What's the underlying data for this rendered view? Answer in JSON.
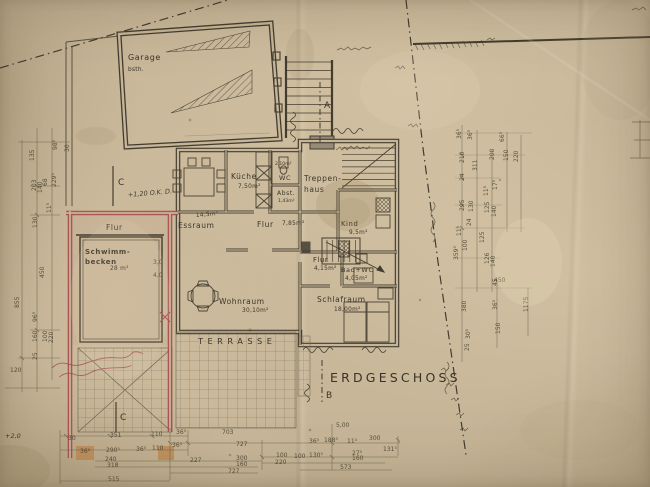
{
  "meta": {
    "type": "architectural floor plan (aged hand-drawn blueprint)",
    "floor": "ERDGESCHOSS"
  },
  "colors": {
    "paper": "#c7b698",
    "ink": "#3e382d",
    "red_pencil": "#a84a52",
    "orange_pencil": "#bf8a52",
    "dim_line": "#5b5442"
  },
  "labels": {
    "garage": {
      "name": "Garage",
      "sub": "bsth."
    },
    "kueche": {
      "name": "Küche",
      "area": "7,50m²"
    },
    "wc": {
      "name": "WC",
      "area": "2,10m²"
    },
    "abstellraum": {
      "name": "Abst.",
      "area": "1,43m²"
    },
    "treppenhaus": {
      "line1": "Treppen-",
      "line2": "haus"
    },
    "essraum": {
      "name": "Essraum",
      "area": "14,5m²"
    },
    "flur_eg": {
      "name": "Flur",
      "area": "7,85m²"
    },
    "kind": {
      "name": "Kind",
      "area": "9,5m²"
    },
    "flur_klein": {
      "name": "Flur",
      "area": "4,15m²"
    },
    "bad": {
      "name": "Bad+WC",
      "area": "4,05m²"
    },
    "wohnraum": {
      "name": "Wohnraum",
      "area": "30,10m²"
    },
    "schlafraum": {
      "name": "Schlafraum",
      "area": "18,00m²"
    },
    "flur_pool": {
      "name": "Flur"
    },
    "schwimmbecken": {
      "line1": "Schwimm-",
      "line2": "becken",
      "area": "28 m²"
    },
    "terrasse": {
      "name": "TERRASSE"
    },
    "erdgeschoss": "ERDGESCHOSS",
    "red_note": "+1,20 O.K. D.",
    "hand_mark": "+2,0"
  },
  "markers": {
    "a": "A",
    "b": "B",
    "c_left": "C",
    "c_bottom": "C"
  },
  "dim_texts": [
    {
      "t": "30",
      "x": 68,
      "y": 440
    },
    {
      "t": "351",
      "x": 110,
      "y": 437
    },
    {
      "t": "110",
      "x": 151,
      "y": 436
    },
    {
      "t": "36⁵",
      "x": 176,
      "y": 434
    },
    {
      "t": "703",
      "x": 222,
      "y": 434
    },
    {
      "t": "36⁵",
      "x": 80,
      "y": 453
    },
    {
      "t": "290⁵",
      "x": 106,
      "y": 452
    },
    {
      "t": "36⁵",
      "x": 136,
      "y": 451
    },
    {
      "t": "110",
      "x": 152,
      "y": 450
    },
    {
      "t": "36⁵",
      "x": 172,
      "y": 447
    },
    {
      "t": "727",
      "x": 236,
      "y": 446
    },
    {
      "t": "240",
      "x": 105,
      "y": 461
    },
    {
      "t": "318",
      "x": 107,
      "y": 467
    },
    {
      "t": "515",
      "x": 108,
      "y": 481
    },
    {
      "t": "227",
      "x": 190,
      "y": 462
    },
    {
      "t": "300",
      "x": 236,
      "y": 460
    },
    {
      "t": "160",
      "x": 236,
      "y": 466
    },
    {
      "t": "727",
      "x": 228,
      "y": 473
    },
    {
      "t": "100",
      "x": 276,
      "y": 457
    },
    {
      "t": "100",
      "x": 294,
      "y": 458
    },
    {
      "t": "130⁵",
      "x": 309,
      "y": 457
    },
    {
      "t": "27⁵",
      "x": 352,
      "y": 455
    },
    {
      "t": "160",
      "x": 352,
      "y": 460
    },
    {
      "t": "220",
      "x": 275,
      "y": 464
    },
    {
      "t": "573",
      "x": 340,
      "y": 469
    },
    {
      "t": "5,00",
      "x": 336,
      "y": 427
    },
    {
      "t": "36⁵",
      "x": 309,
      "y": 443
    },
    {
      "t": "188⁵",
      "x": 324,
      "y": 442
    },
    {
      "t": "11⁵",
      "x": 347,
      "y": 443
    },
    {
      "t": "300",
      "x": 369,
      "y": 440
    },
    {
      "t": "131⁵",
      "x": 383,
      "y": 451
    },
    {
      "t": "135",
      "x": 34,
      "y": 161,
      "r": -90
    },
    {
      "t": "98⁵",
      "x": 57,
      "y": 150,
      "r": -90
    },
    {
      "t": "30",
      "x": 69,
      "y": 152,
      "r": -90
    },
    {
      "t": "203",
      "x": 36,
      "y": 191,
      "r": -90
    },
    {
      "t": "140",
      "x": 42,
      "y": 193,
      "r": -90
    },
    {
      "t": "68",
      "x": 47,
      "y": 186,
      "r": -90
    },
    {
      "t": "229⁵",
      "x": 56,
      "y": 187,
      "r": -90
    },
    {
      "t": "11⁵",
      "x": 51,
      "y": 213,
      "r": -90
    },
    {
      "t": "130",
      "x": 37,
      "y": 228,
      "r": -90
    },
    {
      "t": "450",
      "x": 44,
      "y": 278,
      "r": -90
    },
    {
      "t": "855",
      "x": 19,
      "y": 308,
      "r": -90
    },
    {
      "t": "96⁵",
      "x": 37,
      "y": 322,
      "r": -90
    },
    {
      "t": "160",
      "x": 37,
      "y": 342,
      "r": -90
    },
    {
      "t": "100",
      "x": 47,
      "y": 342,
      "r": -90
    },
    {
      "t": "220",
      "x": 53,
      "y": 343,
      "r": -90
    },
    {
      "t": "25",
      "x": 37,
      "y": 360,
      "r": -90
    },
    {
      "t": "120",
      "x": 10,
      "y": 372
    },
    {
      "t": "36⁵",
      "x": 461,
      "y": 139,
      "r": -90
    },
    {
      "t": "36⁵",
      "x": 472,
      "y": 140,
      "r": -90
    },
    {
      "t": "66⁵",
      "x": 504,
      "y": 142,
      "r": -90
    },
    {
      "t": "210",
      "x": 464,
      "y": 163,
      "r": -90
    },
    {
      "t": "311",
      "x": 477,
      "y": 171,
      "r": -90
    },
    {
      "t": "200",
      "x": 494,
      "y": 160,
      "r": -90
    },
    {
      "t": "150",
      "x": 508,
      "y": 161,
      "r": -90
    },
    {
      "t": "220",
      "x": 518,
      "y": 162,
      "r": -90
    },
    {
      "t": "24",
      "x": 464,
      "y": 181,
      "r": -90
    },
    {
      "t": "17⁵",
      "x": 497,
      "y": 190,
      "r": -90
    },
    {
      "t": "11⁵",
      "x": 488,
      "y": 196,
      "r": -90
    },
    {
      "t": "295",
      "x": 464,
      "y": 211,
      "r": -90
    },
    {
      "t": "130",
      "x": 473,
      "y": 212,
      "r": -90
    },
    {
      "t": "125",
      "x": 489,
      "y": 213,
      "r": -90
    },
    {
      "t": "140",
      "x": 496,
      "y": 217,
      "r": -90
    },
    {
      "t": "24",
      "x": 471,
      "y": 226,
      "r": -90
    },
    {
      "t": "11⁵",
      "x": 461,
      "y": 236,
      "r": -90
    },
    {
      "t": "100",
      "x": 467,
      "y": 251,
      "r": -90
    },
    {
      "t": "359⁵",
      "x": 458,
      "y": 260,
      "r": -90
    },
    {
      "t": "125",
      "x": 484,
      "y": 243,
      "r": -90
    },
    {
      "t": "126",
      "x": 489,
      "y": 264,
      "r": -90
    },
    {
      "t": "140",
      "x": 495,
      "y": 267,
      "r": -90
    },
    {
      "t": "450",
      "x": 494,
      "y": 282
    },
    {
      "t": "380",
      "x": 466,
      "y": 312,
      "r": -90
    },
    {
      "t": "36⁵",
      "x": 497,
      "y": 310,
      "r": -90
    },
    {
      "t": "150",
      "x": 500,
      "y": 334,
      "r": -90
    },
    {
      "t": "1175",
      "x": 528,
      "y": 312,
      "r": -90
    },
    {
      "t": "30⁵",
      "x": 470,
      "y": 339,
      "r": -90
    },
    {
      "t": "25",
      "x": 469,
      "y": 351,
      "r": -90
    },
    {
      "t": "45",
      "x": 497,
      "y": 286,
      "r": -90
    },
    {
      "t": "3,0",
      "x": 153,
      "y": 264,
      "s": 4.6
    },
    {
      "t": "4,0",
      "x": 153,
      "y": 277,
      "s": 4.6
    }
  ]
}
